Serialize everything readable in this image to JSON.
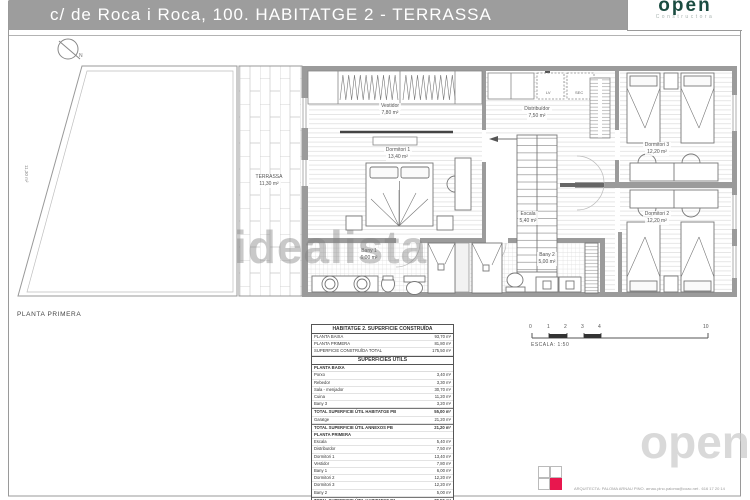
{
  "header": {
    "title": "c/ de Roca i Roca, 100. HABITATGE 2 - TERRASSA",
    "logo": "ópen",
    "logo_sub": "Constructora"
  },
  "plan": {
    "floor_label": "PLANTA PRIMERA",
    "north": "N",
    "side_dimension": "11,30 m²",
    "rooms": {
      "terrassa": {
        "name": "TERRASSA",
        "area": "11,30 m²"
      },
      "vestidor": {
        "name": "Vestidor",
        "area": "7,80 m²"
      },
      "dormitori1": {
        "name": "Dormitori 1",
        "area": "13,40 m²"
      },
      "distribuidor": {
        "name": "Distribuïdor",
        "area": "7,50 m²"
      },
      "escala": {
        "name": "Escala",
        "area": "5,40 m²"
      },
      "dormitori3": {
        "name": "Dormitori 3",
        "area": "12,20 m²"
      },
      "dormitori2": {
        "name": "Dormitori 2",
        "area": "12,20 m²"
      },
      "bany1": {
        "name": "Bany 1",
        "area": "6,00 m²"
      },
      "bany2": {
        "name": "Bany 2",
        "area": "5,00 m²"
      }
    },
    "closets": {
      "lv": "LV",
      "sec": "SEC"
    }
  },
  "table": {
    "title": "HABITATGE 2. SUPERFICIE CONSTRUÏDA",
    "construida": [
      {
        "label": "PLANTA BAIXA",
        "value": "93,70 m²"
      },
      {
        "label": "PLANTA PRIMERA",
        "value": "81,80 m²"
      },
      {
        "label": "SUPERFICIE CONSTRUÏDA TOTAL",
        "value": "175,50 m²"
      }
    ],
    "utils_title": "SUPERFICIES ÚTILS",
    "pb_header": "PLANTA BAIXA",
    "pb_rows": [
      {
        "label": "Porxo",
        "value": "3,40 m²"
      },
      {
        "label": "Rebedor",
        "value": "3,30 m²"
      },
      {
        "label": "Sala - menjador",
        "value": "30,70 m²"
      },
      {
        "label": "Cuina",
        "value": "11,20 m²"
      },
      {
        "label": "Bany 3",
        "value": "3,20 m²"
      },
      {
        "label": "TOTAL SUPERFICIE ÚTIL HABITATGE PB",
        "value": "55,00 m²"
      },
      {
        "label": "Garatge",
        "value": "21,20 m²"
      },
      {
        "label": "TOTAL SUPERFICIE ÚTIL ANNEXOS PB",
        "value": "21,20 m²"
      }
    ],
    "p1_header": "PLANTA PRIMERA",
    "p1_rows": [
      {
        "label": "Escala",
        "value": "5,40 m²"
      },
      {
        "label": "Distribuïdor",
        "value": "7,50 m²"
      },
      {
        "label": "Dormitori 1",
        "value": "13,40 m²"
      },
      {
        "label": "Vestidor",
        "value": "7,80 m²"
      },
      {
        "label": "Bany 1",
        "value": "6,00 m²"
      },
      {
        "label": "Dormitori 2",
        "value": "12,20 m²"
      },
      {
        "label": "Dormitori 3",
        "value": "12,20 m²"
      },
      {
        "label": "Bany 2",
        "value": "5,00 m²"
      },
      {
        "label": "TOTAL SUPERFICIE ÚTIL HABITATGE P1",
        "value": "70,50 m²"
      },
      {
        "label": "SUPERFICIE ÚTIL TOTAL",
        "value": "150,50 m²"
      }
    ]
  },
  "scale": {
    "ticks": [
      "0",
      "1",
      "2",
      "3",
      "4",
      "10"
    ],
    "label": "ESCALA: 1:50"
  },
  "watermarks": {
    "idealista": "idealista",
    "open": "open"
  },
  "footer": {
    "architect": "ARQUITECTA: PALOMA ARNAU PINO. arnau.pino.paloma@coac.net . 616 17 20 14"
  },
  "colors": {
    "header_gray": "#9d9d9d",
    "logo_green": "#1b4c41",
    "accent_red": "#e8174e"
  }
}
